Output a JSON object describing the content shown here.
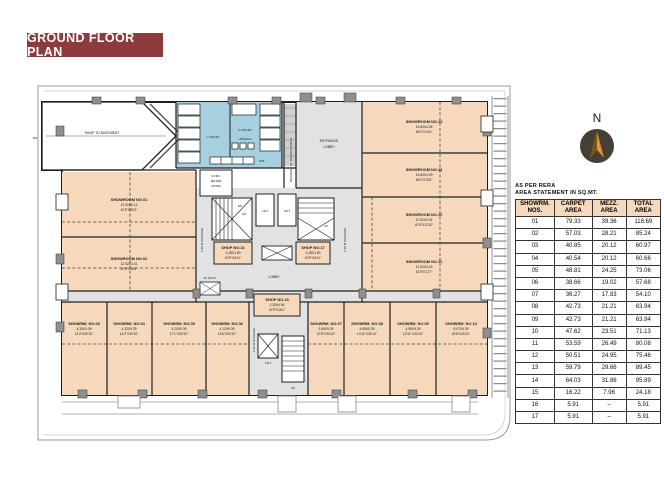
{
  "title": "GROUND FLOOR PLAN",
  "compass": {
    "north_label": "N"
  },
  "area_table": {
    "note": [
      "AS PER RERA",
      "AREA STATEMENT IN SQ.MT."
    ],
    "columns": [
      {
        "l1": "SHOWRM.",
        "l2": "NOS."
      },
      {
        "l1": "CARPET",
        "l2": "AREA"
      },
      {
        "l1": "MEZZ.",
        "l2": "AREA"
      },
      {
        "l1": "TOTAL",
        "l2": "AREA"
      }
    ],
    "rows": [
      {
        "no": "01",
        "carpet": "79.33",
        "mezz": "39.36",
        "total": "118.69"
      },
      {
        "no": "02",
        "carpet": "57.03",
        "mezz": "28.21",
        "total": "85.24"
      },
      {
        "no": "03",
        "carpet": "40.85",
        "mezz": "20.12",
        "total": "60.97"
      },
      {
        "no": "04",
        "carpet": "40.54",
        "mezz": "20.12",
        "total": "60.66"
      },
      {
        "no": "05",
        "carpet": "48.81",
        "mezz": "24.25",
        "total": "73.06"
      },
      {
        "no": "06",
        "carpet": "38.66",
        "mezz": "19.02",
        "total": "57.68"
      },
      {
        "no": "07",
        "carpet": "36.27",
        "mezz": "17.83",
        "total": "54.10"
      },
      {
        "no": "08",
        "carpet": "42.73",
        "mezz": "21.21",
        "total": "63.94"
      },
      {
        "no": "09",
        "carpet": "42.73",
        "mezz": "21.21",
        "total": "63.94"
      },
      {
        "no": "10",
        "carpet": "47.62",
        "mezz": "23.51",
        "total": "71.13"
      },
      {
        "no": "11",
        "carpet": "53.59",
        "mezz": "26.49",
        "total": "80.08"
      },
      {
        "no": "12",
        "carpet": "50.51",
        "mezz": "24.95",
        "total": "75.46"
      },
      {
        "no": "13",
        "carpet": "59.79",
        "mezz": "29.66",
        "total": "89.45"
      },
      {
        "no": "14",
        "carpet": "64.03",
        "mezz": "31.86",
        "total": "95.89"
      },
      {
        "no": "15",
        "carpet": "16.22",
        "mezz": "7.96",
        "total": "24.18"
      },
      {
        "no": "16",
        "carpet": "5.91",
        "mezz": "–",
        "total": "5.91"
      },
      {
        "no": "17",
        "carpet": "5.91",
        "mezz": "–",
        "total": "5.91"
      }
    ]
  },
  "plan": {
    "ramp_label": "RAMP TO BASEMENT",
    "dn": "DN",
    "up": "UP",
    "lift": "LIFT",
    "lobby": "LOBBY",
    "ff_duct": "FF DUCT",
    "passage": "1.50 M PASSAGE",
    "meter_panels": "RESIDENT EL. METER PANELS",
    "meter_room": [
      "COM.L",
      "METER",
      "ROOM"
    ],
    "entrance_lobby": [
      "ENTRANCE",
      "LOBBY"
    ],
    "toilet": {
      "ladies": "L.TOILET",
      "gents": "G.TOILET",
      "urinals": "URINALS",
      "wash_basin": "W.B."
    },
    "rooms": {
      "sr01": {
        "name": "SHOWROOM NO.01",
        "m": "12.92X6.14",
        "ft": "42'5\"X20'2\""
      },
      "sr02": {
        "name": "SHOWROOM NO.02",
        "m": "12.92X4.41",
        "ft": "42'5\"X14'6\""
      },
      "sr03": {
        "name": "SHOWRM. NO.03",
        "m": "4.35X9.39",
        "ft": "14'3\"X30'10\""
      },
      "sr04": {
        "name": "SHOWRM. NO.04",
        "m": "4.32X9.39",
        "ft": "14'2\"X30'10\""
      },
      "sr05": {
        "name": "SHOWRM. NO.05",
        "m": "5.20X9.39",
        "ft": "17'1\"X30'10\""
      },
      "sr06": {
        "name": "SHOWRM. NO.06",
        "m": "4.12X9.39",
        "ft": "13'6\"X30'10\""
      },
      "sr07": {
        "name": "SHOWRM. NO.07",
        "m": "3.86X9.39",
        "ft": "12'8\"X30'10\""
      },
      "sr08": {
        "name": "SHOWRM. NO.08",
        "m": "4.55X9.39",
        "ft": "14'11\"X30'10\""
      },
      "sr09": {
        "name": "SHOWRM. NO.09",
        "m": "4.55X9.39",
        "ft": "14'11\"X30'10\""
      },
      "sr10": {
        "name": "SHOWRM. NO.10",
        "m": "5.07X9.39",
        "ft": "16'8\"X30'10\""
      },
      "sr11": {
        "name": "SHOWROOM NO.11",
        "m": "12.92X4.15",
        "ft": "42'5\"X13'7\""
      },
      "sr12": {
        "name": "SHOWROOM NO.12",
        "m": "12.92X3.91",
        "ft": "42'5\"X12'10\""
      },
      "sr13": {
        "name": "SHOWROOM NO.13",
        "m": "14.63X4.09",
        "ft": "48'0\"X13'5\""
      },
      "sr14": {
        "name": "SHOWROOM NO.14",
        "m": "14.63X4.38",
        "ft": "48'0\"X14'4\""
      },
      "shop15": {
        "name": "SHOP NO.15",
        "m": "3.28X4.94",
        "ft": "10'9\"X16'2\""
      },
      "shop16": {
        "name": "SHOP NO.16",
        "m": "3.28X1.80",
        "ft": "10'9\"X5'11\""
      },
      "shop17": {
        "name": "SHOP NO.17",
        "m": "3.28X1.80",
        "ft": "10'9\"X5'11\""
      }
    },
    "colors": {
      "showroom_fill": "#f6d9bc",
      "toilet_fill": "#a6d0e0",
      "lobby_fill": "#e2e2e2",
      "wall": "#1f1f1f",
      "title_bg": "#8d3b3d",
      "compass_gold": "#d89a33"
    }
  }
}
